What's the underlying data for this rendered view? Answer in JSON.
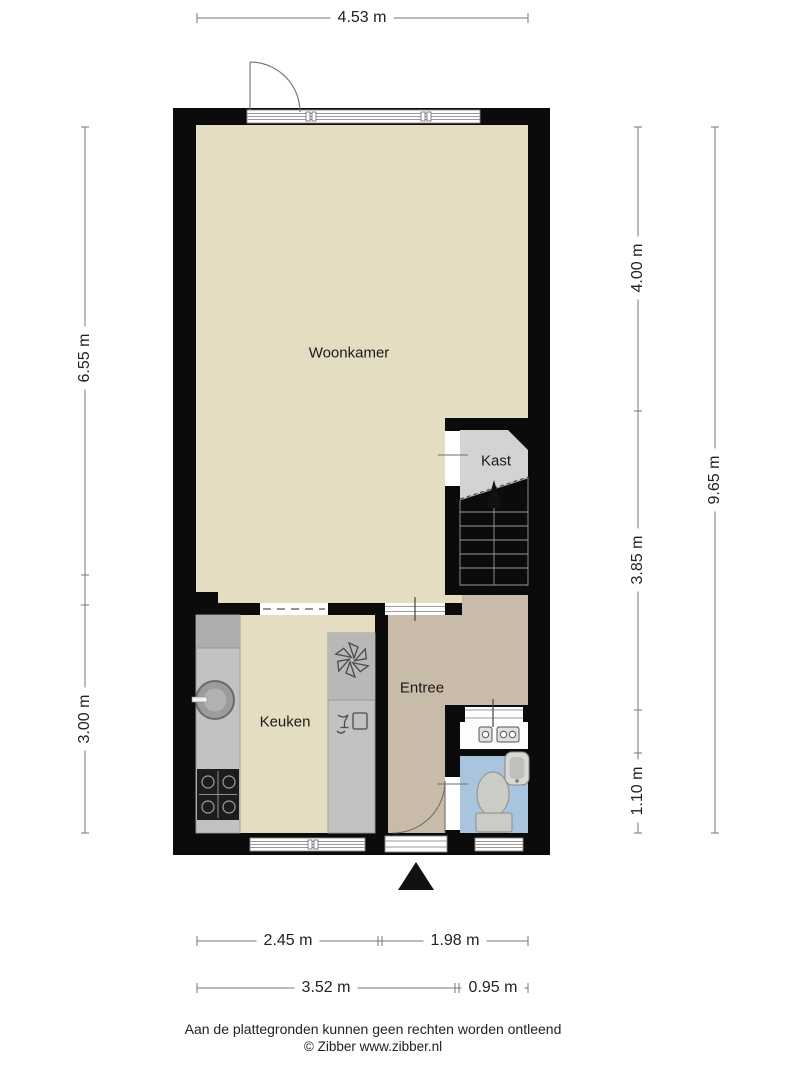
{
  "plan": {
    "rooms": [
      {
        "name": "Woonkamer"
      },
      {
        "name": "Kast"
      },
      {
        "name": "Keuken"
      },
      {
        "name": "Entree"
      }
    ]
  },
  "dimensions": {
    "top": "4.53 m",
    "left_upper": "6.55 m",
    "left_lower": "3.00 m",
    "right_upper": "4.00 m",
    "right_middle": "3.85 m",
    "right_lower": "1.10 m",
    "right_total": "9.65 m",
    "bottom_inner_left": "2.45 m",
    "bottom_inner_right": "1.98 m",
    "bottom_outer_left": "3.52 m",
    "bottom_outer_right": "0.95 m"
  },
  "footer": {
    "disclaimer": "Aan de plattegronden kunnen geen rechten worden ontleend",
    "copyright": "© Zibber www.zibber.nl"
  },
  "colors": {
    "wall": "#0b0b0b",
    "living_floor": "#e4ddc2",
    "entree_floor": "#c9bbaa",
    "wc_floor": "#a9c4df",
    "kast_floor": "#d3d3d3",
    "counter": "#c2c2c0",
    "dimension_line": "#777777",
    "text": "#1a1a1a"
  }
}
